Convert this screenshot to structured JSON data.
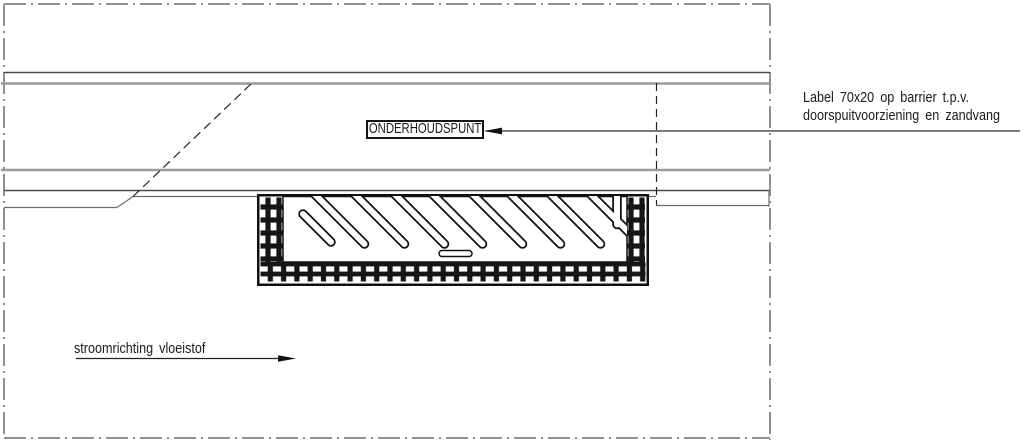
{
  "drawing": {
    "callout": {
      "label": "ONDERHOUDSPUNT"
    },
    "annotation": {
      "line1": "Label 70x20 op barrier t.p.v.",
      "line2": "doorspuitvoorziening en zandvang"
    },
    "flow": {
      "label": "stroomrichting vloeistof"
    }
  },
  "colors": {
    "background": "#ffffff",
    "line_dark": "#1a1a1a",
    "line_medium": "#4a4a4a",
    "line_light": "#9b9b9b",
    "border_gray": "#919191"
  }
}
